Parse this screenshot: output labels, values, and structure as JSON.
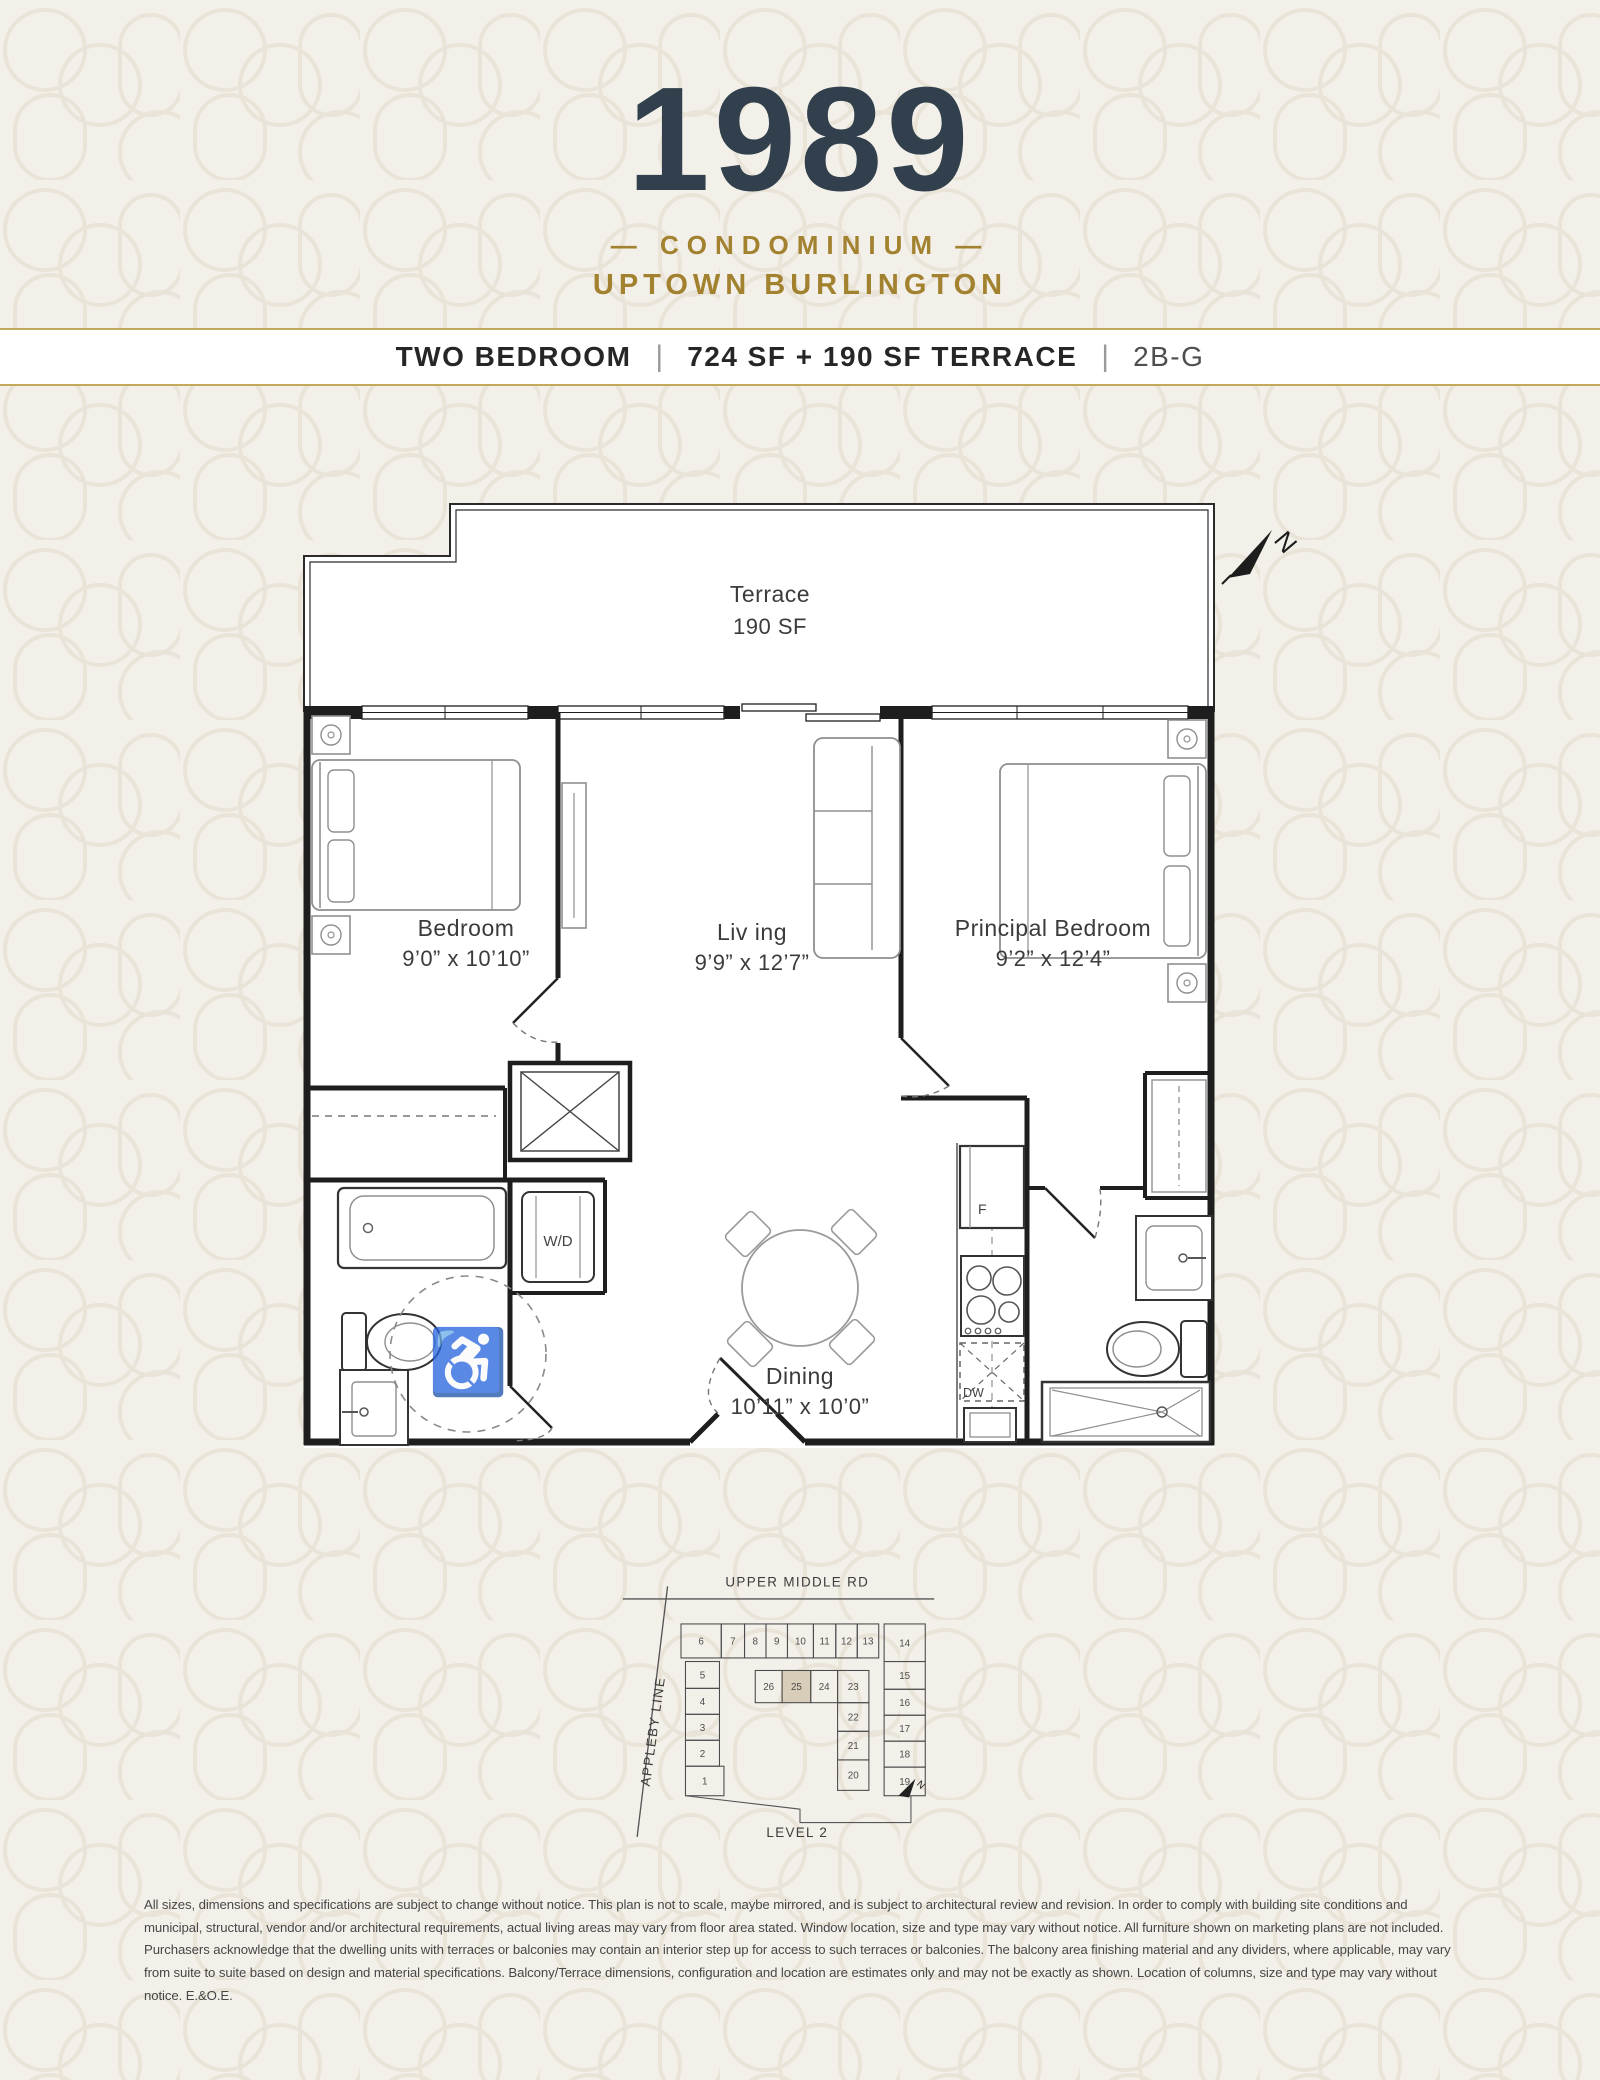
{
  "brand": {
    "name": "1989",
    "tagline_top": "— CONDOMINIUM —",
    "tagline_bottom": "UPTOWN BURLINGTON"
  },
  "title_bar": {
    "plan_type": "TWO BEDROOM",
    "area": "724 SF + 190 SF TERRACE",
    "unit_code": "2B-G",
    "separator": "|"
  },
  "floor_plan": {
    "north_label": "N",
    "terrace": {
      "name": "Terrace",
      "area": "190 SF"
    },
    "rooms": [
      {
        "name": "Bedroom",
        "dimensions": "9’0” x 10’10”"
      },
      {
        "name": "Liv ing",
        "dimensions": "9’9” x 12’7”"
      },
      {
        "name": "Principal Bedroom",
        "dimensions": "9’2” x 12’4”"
      },
      {
        "name": "Dining",
        "dimensions": "10’11” x 10’0”"
      }
    ],
    "labels": {
      "washer_dryer": "W/D",
      "fridge": "F",
      "dishwasher": "DW"
    },
    "icons": {
      "wheelchair_icon": "♿"
    }
  },
  "key_plan": {
    "road_top": "UPPER MIDDLE RD",
    "road_left": "APPLEBY LINE",
    "level": "LEVEL 2",
    "north_label": "N",
    "highlighted_unit": "25",
    "highlight_color": "#d8cdb8",
    "units": [
      {
        "n": "6",
        "x": 95,
        "y": 70,
        "w": 45,
        "h": 38
      },
      {
        "n": "7",
        "x": 140,
        "y": 70,
        "w": 26,
        "h": 38
      },
      {
        "n": "8",
        "x": 166,
        "y": 70,
        "w": 24,
        "h": 38
      },
      {
        "n": "9",
        "x": 190,
        "y": 70,
        "w": 24,
        "h": 38
      },
      {
        "n": "10",
        "x": 214,
        "y": 70,
        "w": 29,
        "h": 38
      },
      {
        "n": "11",
        "x": 243,
        "y": 70,
        "w": 25,
        "h": 38
      },
      {
        "n": "12",
        "x": 268,
        "y": 70,
        "w": 24,
        "h": 38
      },
      {
        "n": "13",
        "x": 292,
        "y": 70,
        "w": 24,
        "h": 38
      },
      {
        "n": "14",
        "x": 322,
        "y": 70,
        "w": 46,
        "h": 42
      },
      {
        "n": "15",
        "x": 322,
        "y": 112,
        "w": 46,
        "h": 31
      },
      {
        "n": "16",
        "x": 322,
        "y": 143,
        "w": 46,
        "h": 29
      },
      {
        "n": "17",
        "x": 322,
        "y": 172,
        "w": 46,
        "h": 29
      },
      {
        "n": "18",
        "x": 322,
        "y": 201,
        "w": 46,
        "h": 29
      },
      {
        "n": "19",
        "x": 322,
        "y": 230,
        "w": 46,
        "h": 32
      },
      {
        "n": "5",
        "x": 100,
        "y": 112,
        "w": 38,
        "h": 30
      },
      {
        "n": "4",
        "x": 100,
        "y": 142,
        "w": 38,
        "h": 29
      },
      {
        "n": "3",
        "x": 100,
        "y": 171,
        "w": 38,
        "h": 29
      },
      {
        "n": "2",
        "x": 100,
        "y": 200,
        "w": 38,
        "h": 29
      },
      {
        "n": "1",
        "x": 100,
        "y": 229,
        "w": 43,
        "h": 33
      },
      {
        "n": "26",
        "x": 178,
        "y": 122,
        "w": 30,
        "h": 36
      },
      {
        "n": "25",
        "x": 208,
        "y": 122,
        "w": 32,
        "h": 36,
        "hl": true
      },
      {
        "n": "24",
        "x": 240,
        "y": 122,
        "w": 30,
        "h": 36
      },
      {
        "n": "23",
        "x": 270,
        "y": 122,
        "w": 35,
        "h": 36
      },
      {
        "n": "22",
        "x": 270,
        "y": 158,
        "w": 35,
        "h": 32
      },
      {
        "n": "21",
        "x": 270,
        "y": 190,
        "w": 35,
        "h": 32
      },
      {
        "n": "20",
        "x": 270,
        "y": 222,
        "w": 35,
        "h": 34
      }
    ]
  },
  "disclaimer": "All sizes, dimensions and specifications are subject to change without notice. This plan is not to scale, maybe mirrored, and is subject to architectural review and revision. In order to comply with building site conditions and municipal, structural, vendor and/or architectural requirements, actual living areas may vary from floor area stated. Window location, size and type may vary without notice. All furniture shown on marketing plans are not included. Purchasers acknowledge that the dwelling units with terraces or balconies may contain an interior step up for access to such terraces or balconies. The balcony area finishing material and any dividers, where applicable, may vary from suite to suite based on design and material specifications. Balcony/Terrace dimensions, configuration and location are estimates only and may not be exactly as shown. Location of columns, size and type may vary without notice. E.&O.E."
}
